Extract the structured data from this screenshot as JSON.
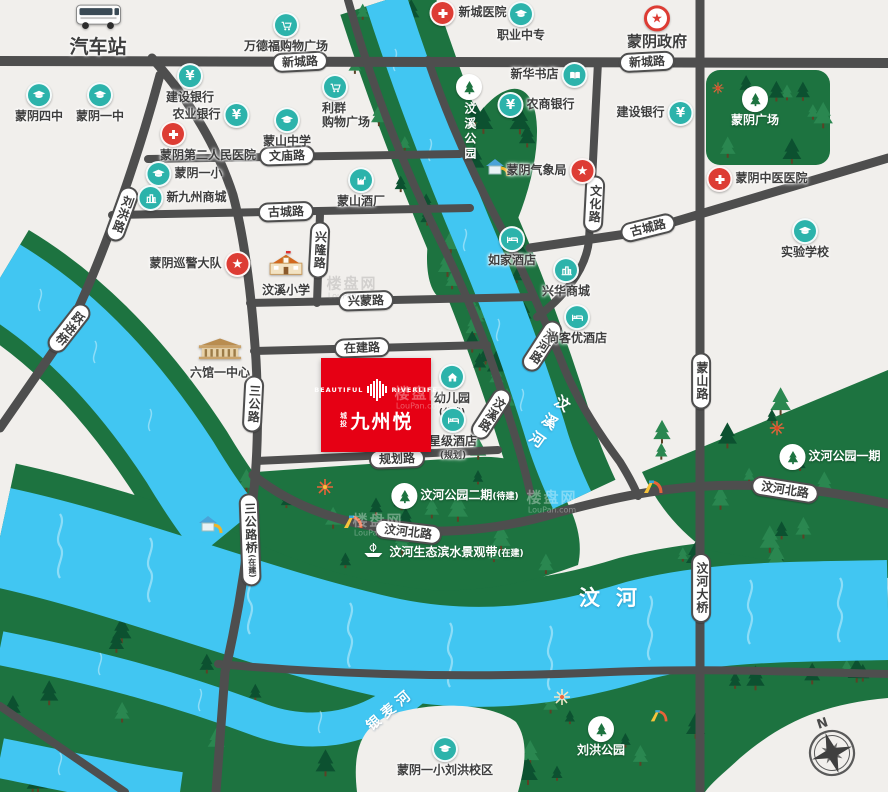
{
  "map": {
    "colors": {
      "background": "#f1efec",
      "road": "#4e4e4e",
      "river": "#41c6f2",
      "park": "#1d7340",
      "tree_dark": "#0c5130",
      "teal": "#2cb3ab",
      "red": "#dd3c34",
      "project_red": "#e60014"
    },
    "project": {
      "brand_left": "BEAUTIFUL",
      "brand_right": "RIVERLIFE",
      "name_prefix": "城投",
      "name": "九州悦"
    },
    "watermark": {
      "title": "楼盘网",
      "sub": "LouPan.com"
    },
    "compass": {
      "label": "N"
    },
    "pois": [
      {
        "id": "bus-station",
        "label": "汽车站",
        "icon": "bus",
        "kind": "building",
        "layout": "top",
        "pos": [
          98,
          30
        ],
        "size": 19
      },
      {
        "id": "wandefu-plaza",
        "label": "万德福购物广场",
        "icon": "cart",
        "kind": "teal",
        "layout": "top",
        "pos": [
          286,
          33
        ]
      },
      {
        "id": "xincheng-hospital",
        "label": "新城医院",
        "icon": "cross",
        "kind": "red",
        "layout": "left",
        "pos": [
          468,
          13
        ]
      },
      {
        "id": "zhiye-zhongzhuan",
        "label": "职业中专",
        "icon": "cap",
        "kind": "teal",
        "layout": "top",
        "pos": [
          521,
          22
        ]
      },
      {
        "id": "mengyin-gov",
        "label": "蒙阴政府",
        "icon": "star",
        "kind": "gov",
        "layout": "top",
        "pos": [
          657,
          28
        ],
        "size": 15
      },
      {
        "id": "jianshe-bank-w",
        "label": "建设银行",
        "icon": "yen",
        "kind": "teal",
        "layout": "top",
        "pos": [
          190,
          84
        ]
      },
      {
        "id": "nongye-bank",
        "label": "农业银行",
        "icon": "yen",
        "kind": "teal",
        "layout": "right",
        "pos": [
          211,
          115
        ]
      },
      {
        "id": "renmin-hospital",
        "label": "蒙阴第二人民医院",
        "icon": "cross",
        "kind": "red",
        "layout": "tl",
        "pos": [
          160,
          121
        ]
      },
      {
        "id": "mengyin-4th",
        "label": "蒙阴四中",
        "icon": "cap",
        "kind": "teal",
        "layout": "top",
        "pos": [
          39,
          103
        ]
      },
      {
        "id": "mengyin-1st",
        "label": "蒙阴一中",
        "icon": "cap",
        "kind": "teal",
        "layout": "top",
        "pos": [
          100,
          103
        ]
      },
      {
        "id": "xinhua-bookstore",
        "label": "新华书店",
        "icon": "book",
        "kind": "teal",
        "layout": "right",
        "pos": [
          549,
          75
        ]
      },
      {
        "id": "liqun-plaza",
        "label": "利群\n购物广场",
        "icon": "cart",
        "kind": "teal",
        "layout": "tl",
        "pos": [
          322,
          74
        ]
      },
      {
        "id": "nongshang-bank",
        "label": "农商银行",
        "icon": "yen",
        "kind": "teal",
        "layout": "left",
        "pos": [
          536,
          105
        ]
      },
      {
        "id": "mengshan-middle",
        "label": "蒙山中学",
        "icon": "cap",
        "kind": "teal",
        "layout": "top",
        "pos": [
          287,
          128
        ]
      },
      {
        "id": "weather-bureau",
        "label": "蒙阴气象局",
        "icon": "star",
        "kind": "star",
        "layout": "right",
        "pos": [
          551,
          171
        ]
      },
      {
        "id": "jianshe-bank-e",
        "label": "建设银行",
        "icon": "yen",
        "kind": "teal",
        "layout": "right",
        "pos": [
          655,
          113
        ]
      },
      {
        "id": "mengyin-square",
        "label": "蒙阴广场",
        "icon": "tree",
        "kind": "park",
        "layout": "top",
        "pos": [
          755,
          107
        ],
        "white": true
      },
      {
        "id": "tcm-hospital",
        "label": "蒙阴中医医院",
        "icon": "cross",
        "kind": "red",
        "layout": "left",
        "pos": [
          757,
          179
        ]
      },
      {
        "id": "shiyan-school",
        "label": "实验学校",
        "icon": "cap",
        "kind": "teal",
        "layout": "top",
        "pos": [
          805,
          239
        ]
      },
      {
        "id": "mengyin-yixiao",
        "label": "蒙阴一小",
        "icon": "cap",
        "kind": "teal",
        "layout": "left",
        "pos": [
          184,
          174
        ]
      },
      {
        "id": "xinjiuzhou-mall",
        "label": "新九州商城",
        "icon": "mall",
        "kind": "teal",
        "layout": "left",
        "pos": [
          182,
          198
        ]
      },
      {
        "id": "mengshan-jiuchang",
        "label": "蒙山酒厂",
        "icon": "factory",
        "kind": "teal",
        "layout": "top",
        "pos": [
          361,
          188
        ]
      },
      {
        "id": "xunjing-dadui",
        "label": "蒙阴巡警大队",
        "icon": "star",
        "kind": "star",
        "layout": "right",
        "pos": [
          200,
          264
        ]
      },
      {
        "id": "wenxi-school",
        "label": "汶溪小学",
        "icon": "schoolhouse",
        "kind": "building",
        "layout": "top",
        "pos": [
          286,
          274
        ]
      },
      {
        "id": "liuguan-center",
        "label": "六馆一中心",
        "icon": "museum",
        "kind": "building",
        "layout": "top",
        "pos": [
          220,
          359
        ]
      },
      {
        "id": "kindergarten",
        "label": "幼儿园",
        "sub": "(公建)",
        "icon": "house",
        "kind": "teal",
        "layout": "top",
        "pos": [
          452,
          391
        ]
      },
      {
        "id": "star-hotel",
        "label": "星级酒店",
        "sub": "(规划)",
        "icon": "bed",
        "kind": "teal",
        "layout": "top",
        "pos": [
          453,
          434
        ]
      },
      {
        "id": "rujia-hotel",
        "label": "如家酒店",
        "icon": "bed",
        "kind": "teal",
        "layout": "top",
        "pos": [
          512,
          247
        ]
      },
      {
        "id": "xinghua-mall",
        "label": "兴华商城",
        "icon": "mall",
        "kind": "teal",
        "layout": "top",
        "pos": [
          566,
          278
        ]
      },
      {
        "id": "shangkeyou-hotel",
        "label": "尚客优酒店",
        "icon": "bed",
        "kind": "teal",
        "layout": "top",
        "pos": [
          577,
          325
        ]
      },
      {
        "id": "wenxi-park",
        "label": "汶溪公园",
        "icon": "tree",
        "kind": "park",
        "layout": "top",
        "pos": [
          469,
          118
        ],
        "white": true,
        "vertical": true
      },
      {
        "id": "wenhe-park-2",
        "label": "汶河公园二期",
        "sub": "(待建)",
        "subInline": true,
        "icon": "tree",
        "kind": "park",
        "layout": "left",
        "pos": [
          455,
          496
        ],
        "white": true
      },
      {
        "id": "wenhe-park-1",
        "label": "汶河公园一期",
        "icon": "tree",
        "kind": "park",
        "layout": "left",
        "pos": [
          830,
          457
        ],
        "white": true
      },
      {
        "id": "scenic-belt",
        "label": "汶河生态滨水景观带",
        "sub": "(在建)",
        "subInline": true,
        "icon": "boat",
        "kind": "plain",
        "layout": "left",
        "pos": [
          442,
          553
        ],
        "white": true
      },
      {
        "id": "liuhong-park",
        "label": "刘洪公园",
        "icon": "tree",
        "kind": "park",
        "layout": "top",
        "pos": [
          601,
          737
        ],
        "white": true
      },
      {
        "id": "liuhong-campus",
        "label": "蒙阴一小刘洪校区",
        "icon": "cap",
        "kind": "teal",
        "layout": "top",
        "pos": [
          445,
          757
        ]
      }
    ],
    "road_labels": [
      {
        "id": "xincheng-rd-w",
        "label": "新城路",
        "pos": [
          300,
          62
        ],
        "rot": -3
      },
      {
        "id": "xincheng-rd-e",
        "label": "新城路",
        "pos": [
          647,
          62
        ],
        "rot": -3
      },
      {
        "id": "wenmiao-rd",
        "label": "文庙路",
        "pos": [
          287,
          156
        ],
        "rot": -2
      },
      {
        "id": "gucheng-rd-w",
        "label": "古城路",
        "pos": [
          286,
          212
        ],
        "rot": -2
      },
      {
        "id": "gucheng-rd-e",
        "label": "古城路",
        "pos": [
          648,
          228
        ],
        "rot": -14
      },
      {
        "id": "xingmeng-rd",
        "label": "兴蒙路",
        "pos": [
          366,
          301
        ],
        "rot": -2
      },
      {
        "id": "zaijian-rd",
        "label": "在建路",
        "pos": [
          362,
          348
        ],
        "rot": -2
      },
      {
        "id": "guihua-rd",
        "label": "规划路",
        "pos": [
          397,
          459
        ],
        "rot": -2
      },
      {
        "id": "wenhebei-rd-w",
        "label": "汶河北路",
        "pos": [
          408,
          532
        ],
        "rot": 7
      },
      {
        "id": "wenhebei-rd-e",
        "label": "汶河北路",
        "pos": [
          785,
          490
        ],
        "rot": 9
      },
      {
        "id": "liuhong-rd",
        "label": "刘洪路",
        "pos": [
          122,
          214
        ],
        "rot": 20,
        "vert": true
      },
      {
        "id": "xinglong-rd",
        "label": "兴隆路",
        "pos": [
          319,
          250
        ],
        "rot": 3,
        "vert": true
      },
      {
        "id": "sangong-rd",
        "label": "三公路",
        "pos": [
          253,
          404
        ],
        "rot": 3,
        "vert": true
      },
      {
        "id": "sangong-bridge",
        "label": "三公路桥",
        "sub": "(在建)",
        "pos": [
          250,
          540
        ],
        "rot": -2,
        "vert": true
      },
      {
        "id": "wenhua-rd",
        "label": "文化路",
        "pos": [
          594,
          204
        ],
        "rot": 3,
        "vert": true
      },
      {
        "id": "mengshan-rd",
        "label": "蒙山路",
        "pos": [
          701,
          381
        ],
        "rot": 0,
        "vert": true
      },
      {
        "id": "wenhe-bridge",
        "label": "汶河大桥",
        "pos": [
          701,
          588
        ],
        "rot": 0,
        "vert": true
      },
      {
        "id": "wenxi-rd",
        "label": "汶溪路",
        "pos": [
          491,
          414
        ],
        "rot": 33,
        "vert": true
      },
      {
        "id": "binhe-rd",
        "label": "滨河路",
        "pos": [
          542,
          346
        ],
        "rot": 33,
        "vert": true
      },
      {
        "id": "yuejin-bridge",
        "label": "跃进桥",
        "pos": [
          69,
          328
        ],
        "rot": 38,
        "vert": true
      }
    ],
    "river_labels": [
      {
        "id": "wenxi-river",
        "label": "汶溪河",
        "pos": [
          548,
          424
        ],
        "rot": 35,
        "vert": true,
        "spacing": 7,
        "size": 15
      },
      {
        "id": "wen-river",
        "label": "汶河",
        "pos": [
          616,
          597
        ],
        "rot": 0,
        "vert": false,
        "spacing": 16,
        "size": 21
      },
      {
        "id": "yinmai-river",
        "label": "银麦河",
        "pos": [
          390,
          709
        ],
        "rot": -40,
        "vert": false,
        "spacing": 5,
        "size": 14
      }
    ],
    "watermarks": [
      {
        "pos": [
          352,
          288
        ],
        "tone": "dark"
      },
      {
        "pos": [
          378,
          525
        ],
        "tone": "light"
      },
      {
        "pos": [
          552,
          502
        ],
        "tone": "light"
      },
      {
        "pos": [
          420,
          398
        ],
        "tone": "light"
      }
    ]
  }
}
